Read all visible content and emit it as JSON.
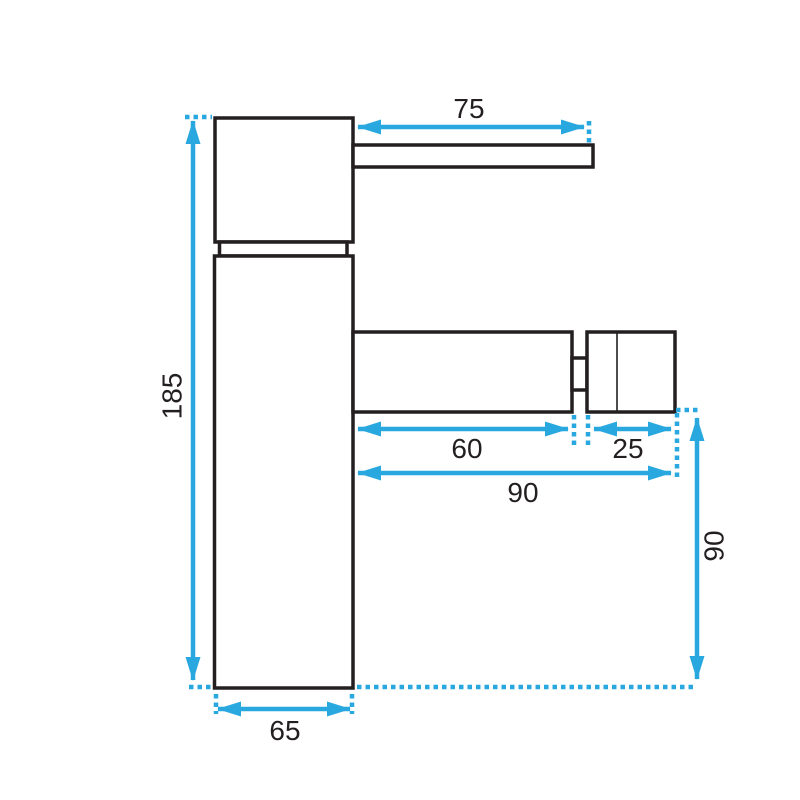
{
  "drawing": {
    "type": "technical-drawing",
    "units": "mm",
    "colors": {
      "background": "#ffffff",
      "outline": "#231f20",
      "dimension": "#29a8e0",
      "text": "#231f20"
    },
    "dimensions": {
      "handle_length": "75",
      "total_height": "185",
      "spout_length": "60",
      "aerator_width": "25",
      "spout_reach": "90",
      "outlet_height": "90",
      "base_width": "65"
    }
  }
}
